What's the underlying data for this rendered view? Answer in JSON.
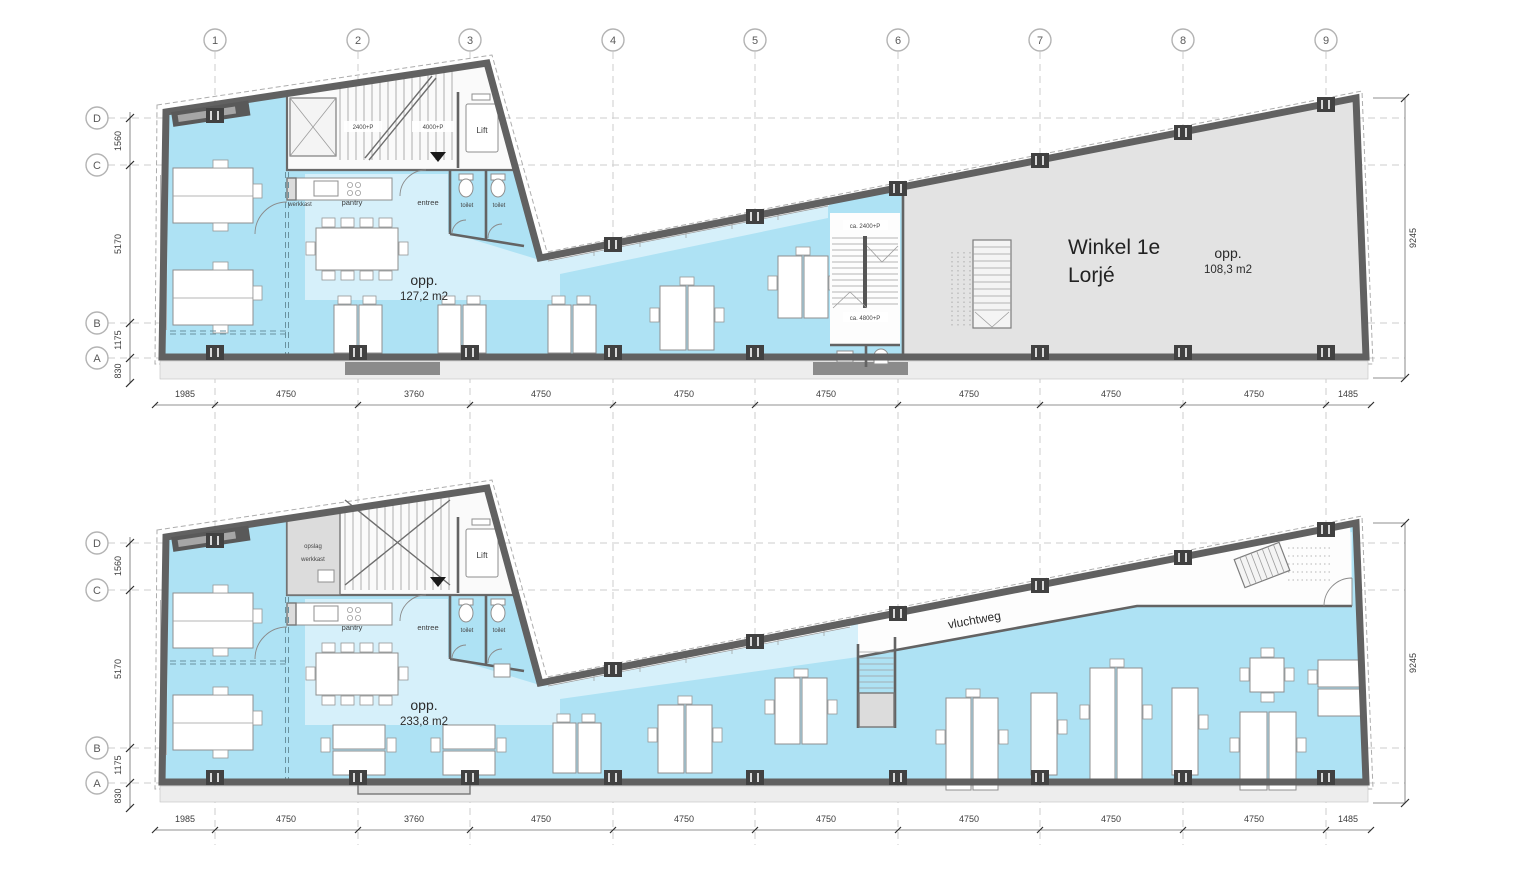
{
  "drawing": {
    "grid_columns": [
      "1",
      "2",
      "3",
      "4",
      "5",
      "6",
      "7",
      "8",
      "9"
    ],
    "grid_rows": [
      "D",
      "C",
      "B",
      "A"
    ],
    "dims": {
      "left": [
        "1560",
        "5170",
        "1175",
        "830"
      ],
      "right": "9245",
      "bottom": [
        "1985",
        "4750",
        "3760",
        "4750",
        "4750",
        "4750",
        "4750",
        "4750",
        "4750",
        "1485"
      ]
    },
    "floor1": {
      "stair_label_1": "2400+P",
      "stair_label_2": "4000+P",
      "lift": "Lift",
      "werkkast": "werkkast",
      "pantry": "pantry",
      "entree": "entree",
      "toilet_1": "toilet",
      "toilet_2": "toilet",
      "toilet_3": "toilet",
      "stair2_top": "ca. 2400+P",
      "stair2_bottom": "ca. 4800+P",
      "area_label": "opp.",
      "area_value": "127,2 m2",
      "winkel_line1": "Winkel 1e",
      "winkel_line2": "Lorjé",
      "winkel_area_label": "opp.",
      "winkel_area_value": "108,3 m2"
    },
    "floor2": {
      "opslag": "opslag",
      "werkkast": "werkkast",
      "lift": "Lift",
      "pantry": "pantry",
      "entree": "entree",
      "toilet_1": "toilet",
      "toilet_2": "toilet",
      "area_label": "opp.",
      "area_value": "233,8 m2",
      "vluchtweg": "vluchtweg"
    }
  }
}
